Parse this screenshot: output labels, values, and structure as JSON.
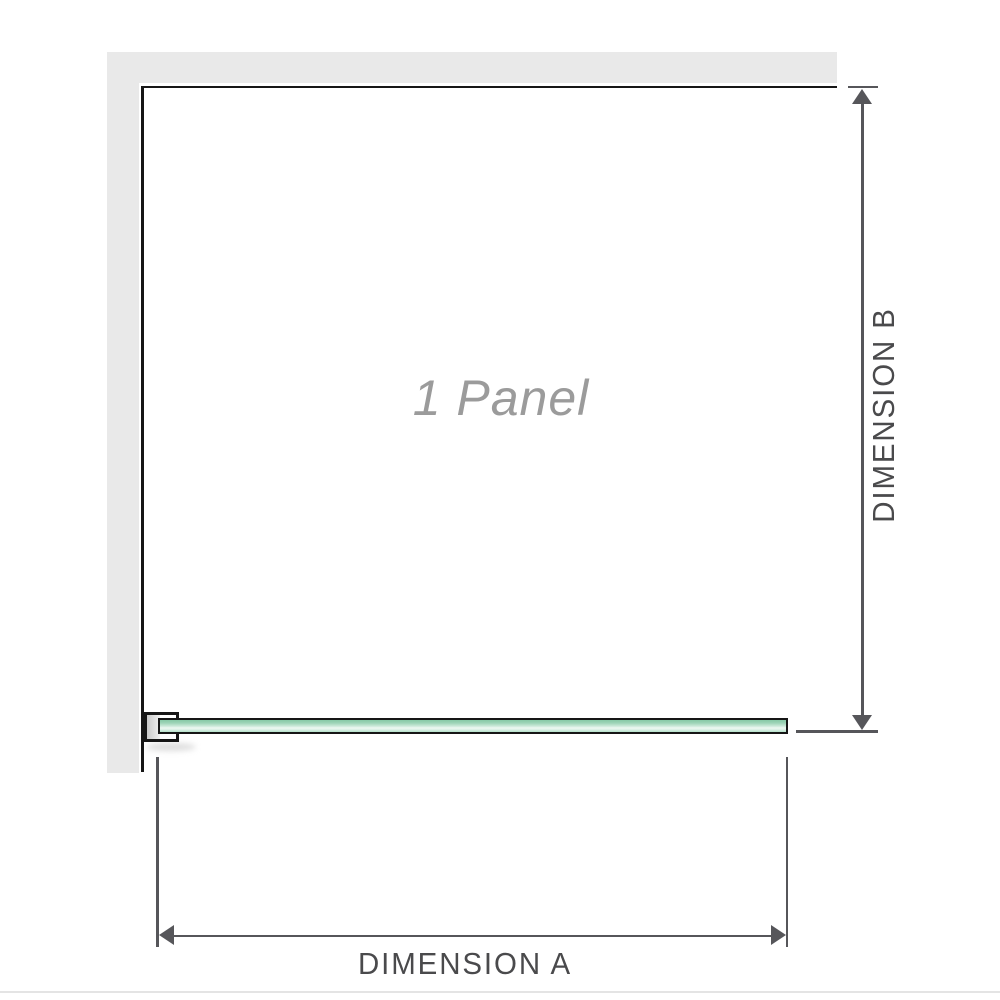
{
  "diagram": {
    "panel_label": "1 Panel",
    "dimensions": {
      "a_label": "DIMENSION A",
      "b_label": "DIMENSION B"
    }
  },
  "icons": {
    "arrowhead_up": "arrowhead-up-icon",
    "arrowhead_down": "arrowhead-down-icon",
    "arrowhead_left": "arrowhead-left-icon",
    "arrowhead_right": "arrowhead-right-icon"
  },
  "colors": {
    "wall-fill": "#e9e9e9",
    "edge-black": "#161616",
    "glass-dark": "#86c9a6",
    "glass-light": "#eef8f2",
    "dim-line": "#56565a",
    "dim-text": "#4a4a4c",
    "panel-label": "#9b9b9b",
    "bottom-rule": "#e4e4e4"
  }
}
